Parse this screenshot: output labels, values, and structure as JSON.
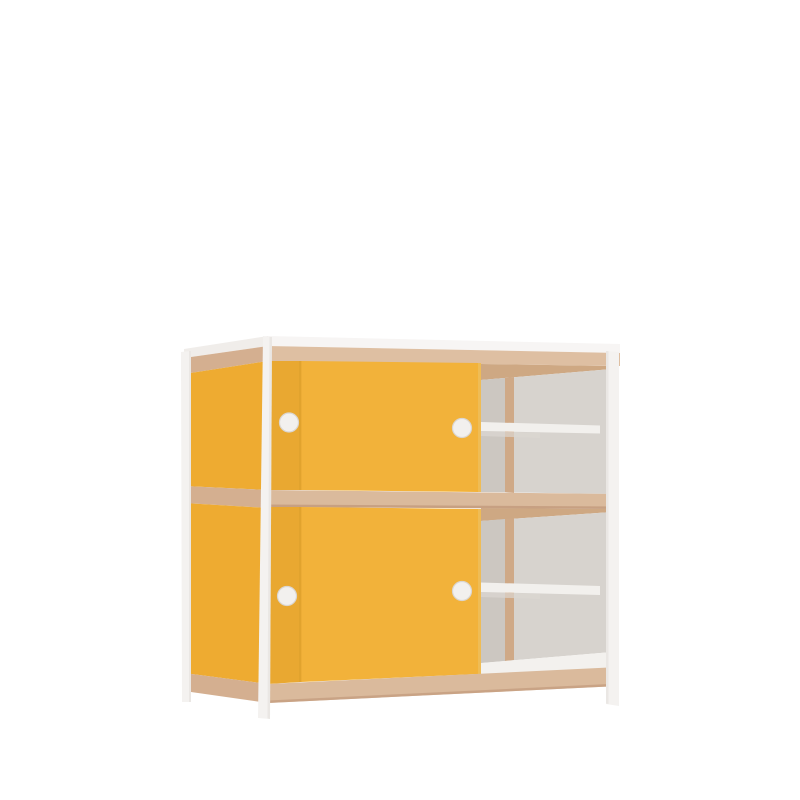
{
  "scene": {
    "description": "3D product render of a two-tier cabinet with a white metal frame, plywood edge bands, yellow sliding doors slid to the left, and open right compartments showing white shelves",
    "background": "#ffffff"
  },
  "colors": {
    "white_top": "#F7F5F4",
    "white_top_side": "#F0EDEA",
    "frame_white": "#F4F2F0",
    "frame_shadow": "#E0DCD8",
    "wood_front": "#DABA9C",
    "wood_front_top": "#DEBFA2",
    "wood_side": "#D4AF90",
    "wood_edge_dark": "#C29A7C",
    "wood_divider": "#CFA987",
    "wood_ceiling": "#CEA883",
    "door_yellow": "#F2B23A",
    "door_yellow_dark": "#E9A831",
    "side_yellow": "#EEAB31",
    "door_edge": "#EFBC55",
    "seam_shadow": "#DA9F2B",
    "interior_light": "#D7D3CE",
    "interior_dark": "#CCC7C1",
    "shelf_white": "#F2F0ED",
    "shelf_shadow": "#DBD7D2",
    "floor_white": "#F3F1EE",
    "handle_fill": "#F2F0EE",
    "handle_rim": "#DAD6D2"
  }
}
